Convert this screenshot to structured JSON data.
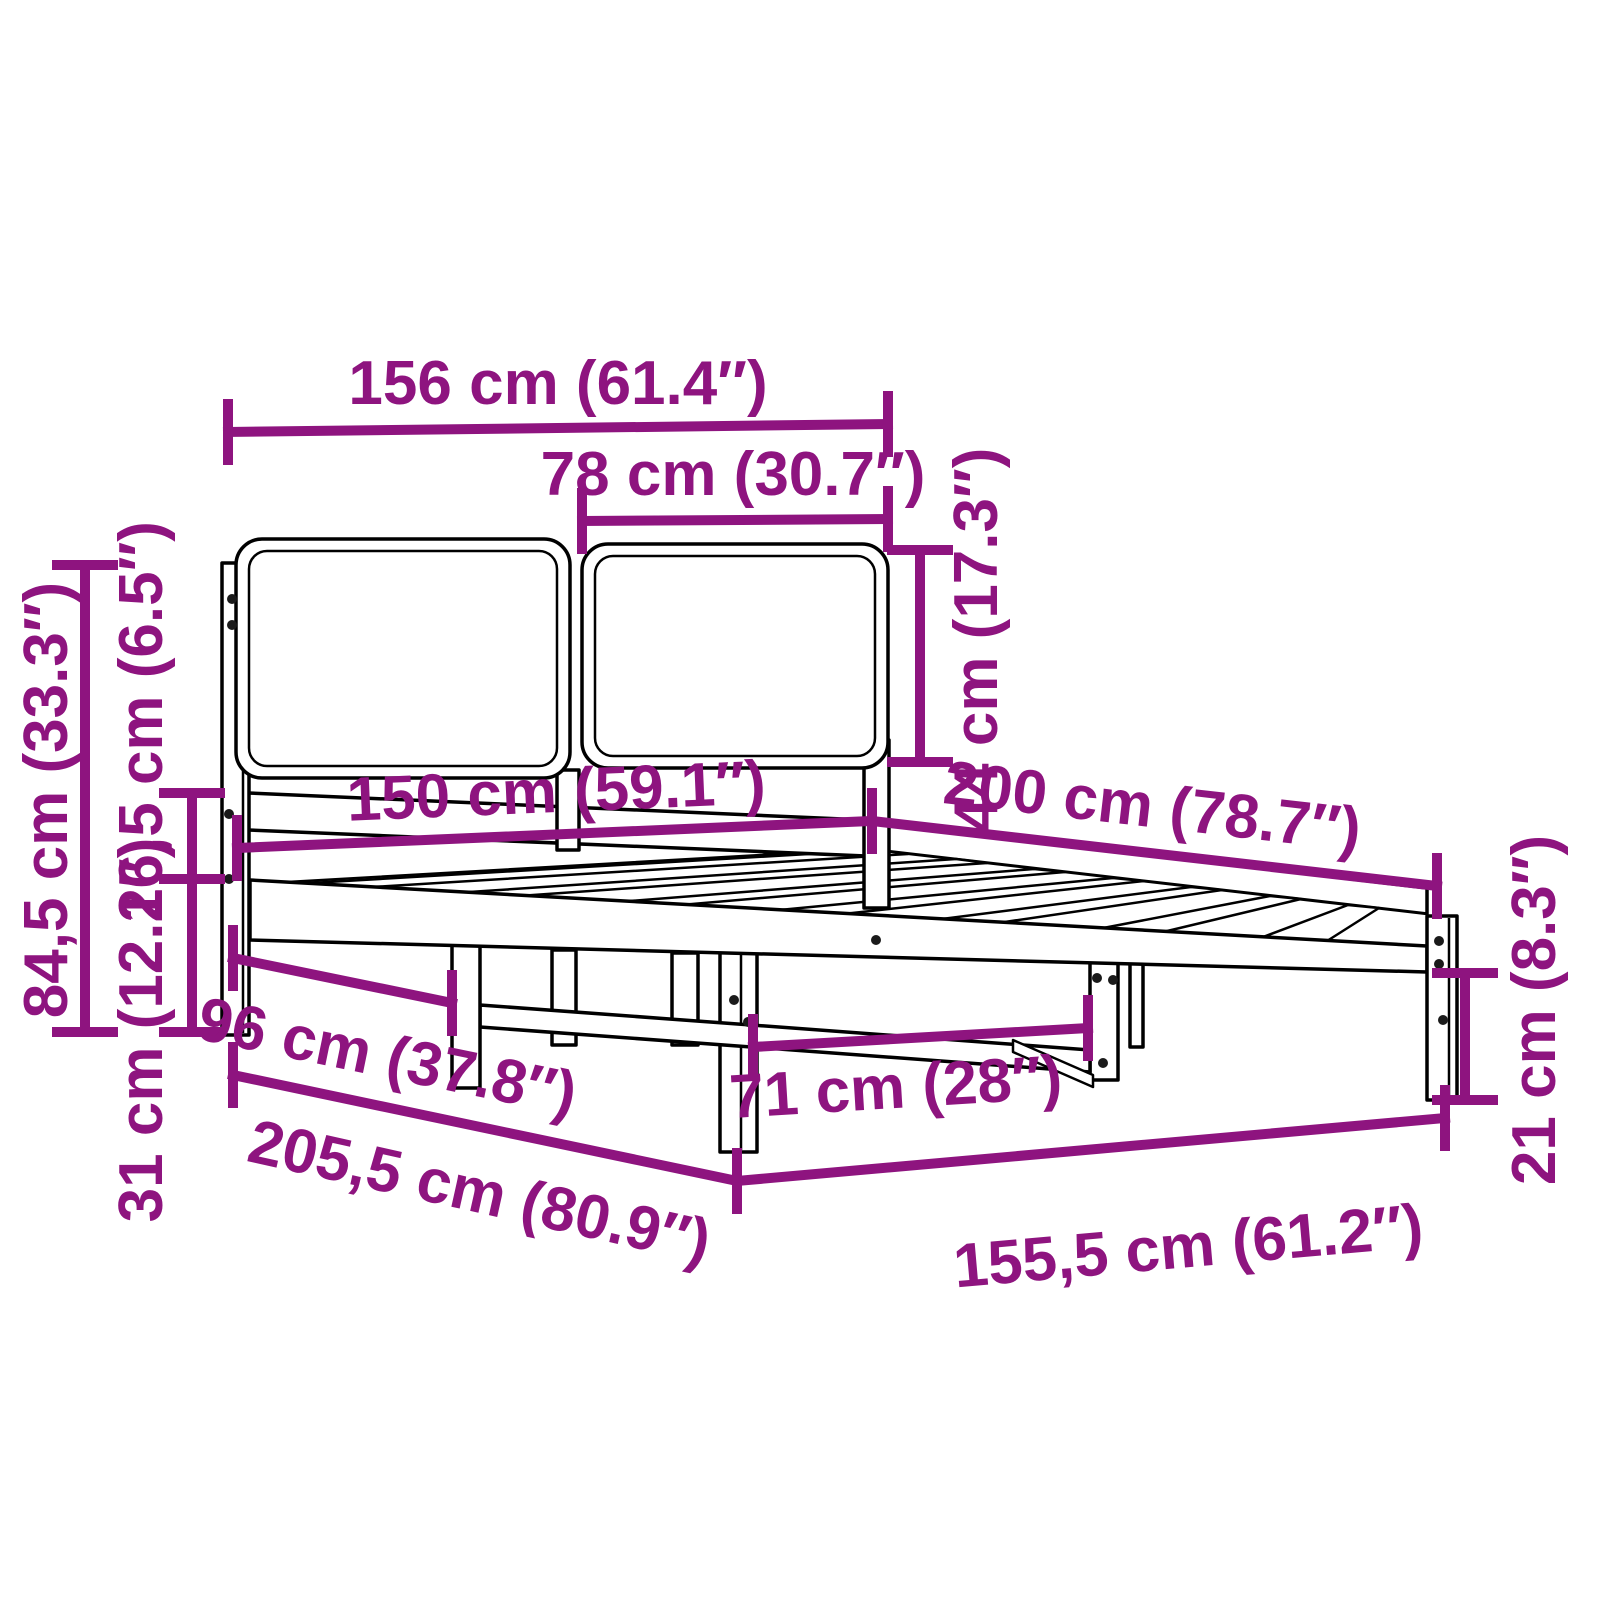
{
  "diagram": {
    "type": "product-dimension-diagram",
    "product": "bed-frame-with-upholstered-headboard",
    "accent_color": "#8E147F",
    "outline_color": "#000000",
    "background_color": "#FFFFFF",
    "labels": {
      "headboard_total_width": "156 cm (61.4″)",
      "headboard_panel_width": "78 cm (30.7″)",
      "headboard_panel_height": "44 cm (17.3″)",
      "headboard_total_height": "84,5 cm (33.3″)",
      "panel_to_frame_gap": "16,5 cm (6.5″)",
      "frame_top_height": "31 cm (12.2″)",
      "mattress_width": "150 cm (59.1″)",
      "mattress_length": "200 cm (78.7″)",
      "headboard_to_front_leg": "96 cm (37.8″)",
      "total_length": "205,5 cm (80.9″)",
      "total_width": "155,5 cm (61.2″)",
      "center_leg_clear_span": "71 cm (28″)",
      "underbed_clearance": "21 cm (8.3″)"
    }
  }
}
